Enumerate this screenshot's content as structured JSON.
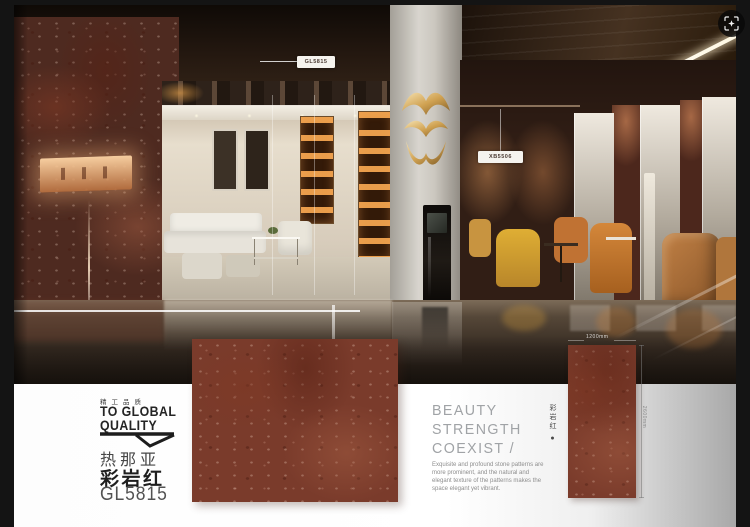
{
  "viewer": {
    "image_search_icon": "scan-frame-sparkle"
  },
  "scene": {
    "label_left": "GL5815",
    "label_right": "XB5506"
  },
  "brand": {
    "tagline_cn": "精工品质",
    "slogan_line1": "TO GLOBAL",
    "slogan_line2": "QUALITY"
  },
  "product": {
    "series_cn": "热那亚",
    "name_cn": "彩岩红",
    "code": "GL5815"
  },
  "headline": {
    "line1": "BEAUTY",
    "line2": "STRENGTH",
    "line3": "COEXIST /"
  },
  "side_label_cn": "彩岩红 ●",
  "description": "Exquisite and profound stone patterns are more prominent, and the natural and elegant texture of the patterns makes the space elegant yet vibrant.",
  "dimensions": {
    "width_label": "1200mm",
    "height_label": "2600mm"
  },
  "colors": {
    "tile_base": "#7a3b2b",
    "gold_accent": "#c99a4e",
    "headline_gray": "#a0a3a6",
    "brand_text": "#242424",
    "band_bg": "#ffffff"
  }
}
